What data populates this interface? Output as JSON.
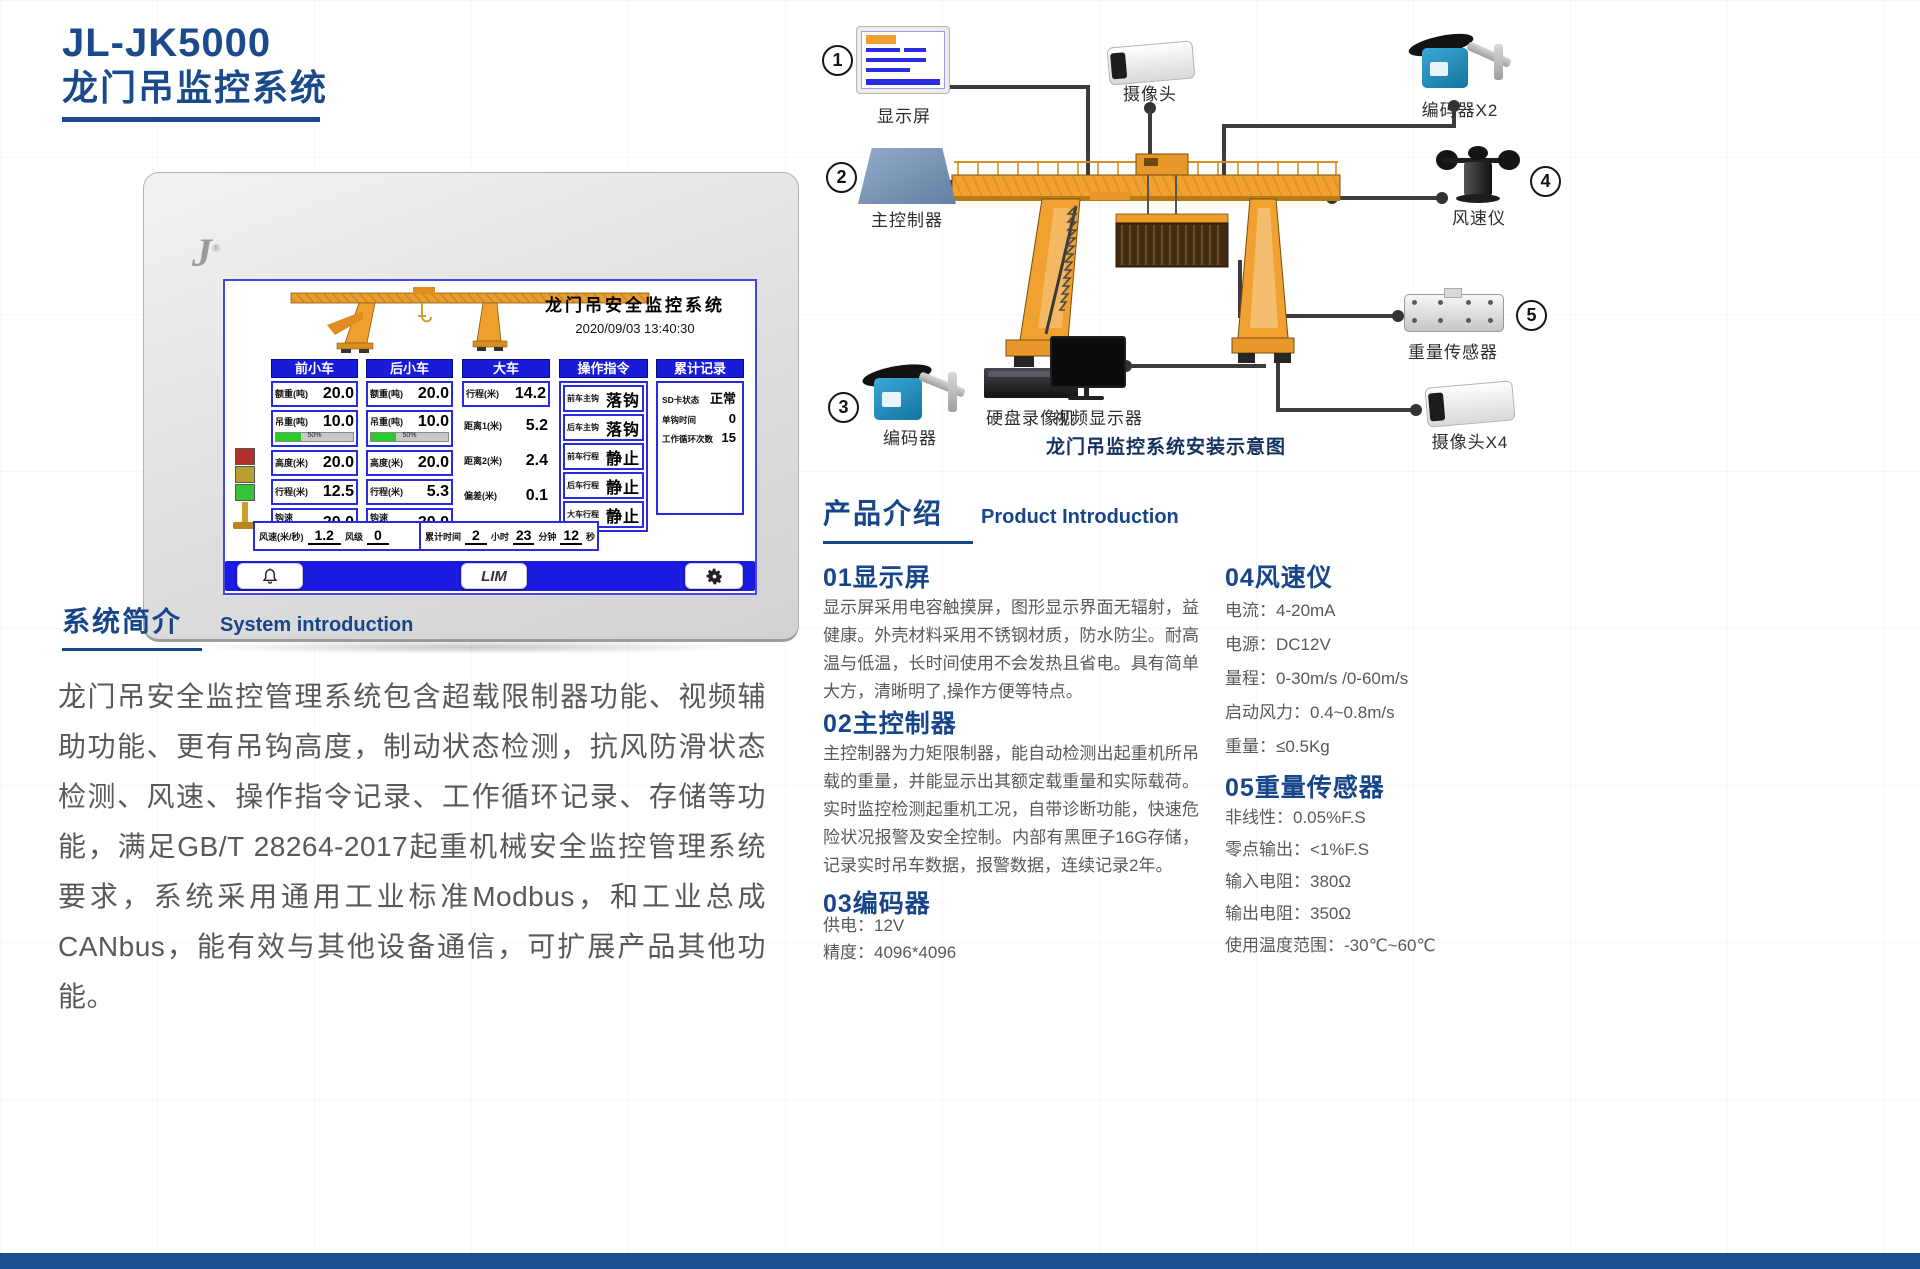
{
  "page": {
    "model": "JL-JK5000",
    "product_name": "龙门吊监控系统"
  },
  "colors": {
    "accent_blue": "#17458a",
    "panel_blue": "#1a1ad9",
    "crane_orange": "#f0a12f",
    "footer_blue": "#1d4f93",
    "progress_green": "#27cc27"
  },
  "device": {
    "logo_letter": "J",
    "screen": {
      "title": "龙门吊安全监控系统",
      "datetime": "2020/09/03 13:40:30",
      "panels": [
        {
          "header": "前小车",
          "rows": [
            {
              "label": "额重(吨)",
              "value": "20.0"
            },
            {
              "label": "吊重(吨)",
              "value": "10.0",
              "progress_label": "50%",
              "progress_percent": 33
            },
            {
              "label": "高度(米)",
              "value": "20.0"
            },
            {
              "label": "行程(米)",
              "value": "12.5"
            },
            {
              "label": "钩速\n(米/分)",
              "value": "20.0"
            }
          ]
        },
        {
          "header": "后小车",
          "rows": [
            {
              "label": "额重(吨)",
              "value": "20.0"
            },
            {
              "label": "吊重(吨)",
              "value": "10.0",
              "progress_label": "50%",
              "progress_percent": 33
            },
            {
              "label": "高度(米)",
              "value": "20.0"
            },
            {
              "label": "行程(米)",
              "value": "5.3"
            },
            {
              "label": "钩速\n(米/分)",
              "value": "20.0"
            }
          ]
        },
        {
          "header": "大车",
          "rows": [
            {
              "label": "行程(米)",
              "value": "14.2"
            },
            {
              "label": "距离1(米)",
              "value": "5.2"
            },
            {
              "label": "距离2(米)",
              "value": "2.4"
            },
            {
              "label": "偏差(米)",
              "value": "0.1"
            }
          ]
        },
        {
          "header": "操作指令",
          "rows": [
            {
              "label": "前车主钩",
              "value": "落钩"
            },
            {
              "label": "后车主钩",
              "value": "落钩"
            },
            {
              "label": "前车行程",
              "value": "静止"
            },
            {
              "label": "后车行程",
              "value": "静止"
            },
            {
              "label": "大车行程",
              "value": "静止"
            }
          ]
        },
        {
          "header": "累计记录",
          "rows": [
            {
              "label": "SD卡状态",
              "value": "正常"
            },
            {
              "label": "单钩时间",
              "value": "0"
            },
            {
              "label": "工作循环次数",
              "value": "15"
            }
          ]
        }
      ],
      "wind": {
        "speed_label": "风速(米/秒)",
        "speed_value": "1.2",
        "scale_label": "风级",
        "scale_value": "0"
      },
      "runtime": {
        "label": "累计时间",
        "hours": "2",
        "hours_unit": "小时",
        "minutes": "23",
        "minutes_unit": "分钟",
        "seconds": "12",
        "seconds_unit": "秒"
      },
      "toolbar": {
        "lim_label": "LIM"
      }
    }
  },
  "diagram": {
    "caption": "龙门吊监控系统安装示意图",
    "display": {
      "num": "1",
      "label": "显示屏"
    },
    "controller": {
      "num": "2",
      "label": "主控制器"
    },
    "encoder": {
      "num": "3",
      "label": "编码器"
    },
    "anemometer": {
      "num": "4",
      "label": "风速仪"
    },
    "weight_sensor": {
      "num": "5",
      "label": "重量传感器"
    },
    "camera": {
      "label": "摄像头"
    },
    "encoder_x2": {
      "label": "编码器X2"
    },
    "dvr": {
      "label": "硬盘录像机"
    },
    "video_monitor": {
      "label": "视频显示器"
    },
    "camera_x4": {
      "label": "摄像头X4"
    }
  },
  "system_intro": {
    "title_zh": "系统简介",
    "title_en": "System introduction",
    "body": "龙门吊安全监控管理系统包含超载限制器功能、视频辅助功能、更有吊钩高度，制动状态检测，抗风防滑状态检测、风速、操作指令记录、工作循环记录、存储等功能，满足GB/T 28264-2017起重机械安全监控管理系统要求，系统采用通用工业标准Modbus，和工业总成CANbus，能有效与其他设备通信，可扩展产品其他功能。"
  },
  "product_intro": {
    "title_zh": "产品介绍",
    "title_en": "Product Introduction",
    "sections": [
      {
        "heading": "01显示屏",
        "body": "显示屏采用电容触摸屏，图形显示界面无辐射，益健康。外壳材料采用不锈钢材质，防水防尘。耐高温与低温，长时间使用不会发热且省电。具有简单大方，清晰明了,操作方便等特点。"
      },
      {
        "heading": "02主控制器",
        "body": "主控制器为力矩限制器，能自动检测出起重机所吊载的重量，并能显示出其额定载重量和实际载荷。实时监控检测起重机工况，自带诊断功能，快速危险状况报警及安全控制。内部有黑匣子16G存储，记录实时吊车数据，报警数据，连续记录2年。"
      },
      {
        "heading": "03编码器",
        "specs": [
          "供电：12V",
          "精度：4096*4096"
        ]
      },
      {
        "heading": "04风速仪",
        "specs": [
          "电流：4-20mA",
          "电源：DC12V",
          "量程：0-30m/s /0-60m/s",
          "启动风力：0.4~0.8m/s",
          "重量：≤0.5Kg"
        ]
      },
      {
        "heading": "05重量传感器",
        "specs": [
          "非线性：0.05%F.S",
          "零点输出：<1%F.S",
          "输入电阻：380Ω",
          "输出电阻：350Ω",
          "使用温度范围：-30℃~60℃"
        ]
      }
    ]
  }
}
